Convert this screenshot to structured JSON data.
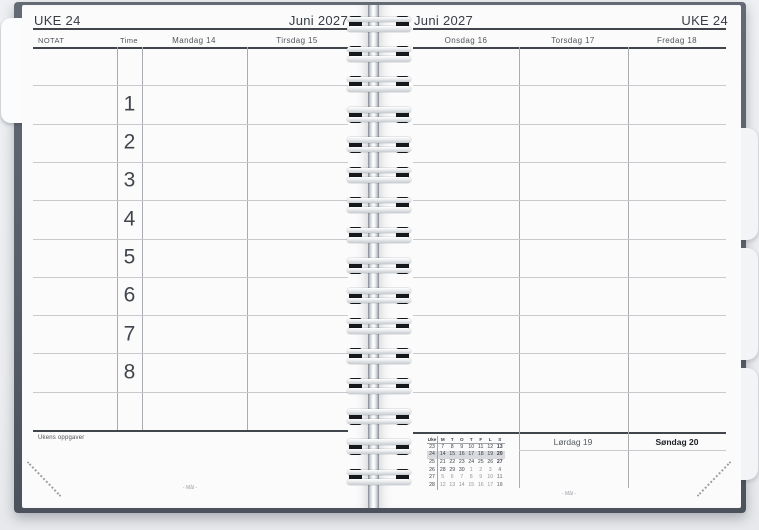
{
  "left_page": {
    "week_label": "UKE 24",
    "month_label": "Juni 2027",
    "columns": {
      "notat": "NOTAT",
      "time": "Time",
      "day1": "Mandag 14",
      "day2": "Tirsdag 15"
    },
    "hours": [
      "1",
      "2",
      "3",
      "4",
      "5",
      "6",
      "7",
      "8"
    ],
    "tasks_label": "Ukens oppgaver",
    "footer": "- Mål -"
  },
  "right_page": {
    "month_label": "Juni 2027",
    "week_label": "UKE 24",
    "columns": [
      "Onsdag 16",
      "Torsdag 17",
      "Fredag 18"
    ],
    "weekend": {
      "saturday": "Lørdag 19",
      "sunday": "Søndag 20"
    },
    "mini_calendar": {
      "header": [
        "Uke",
        "M",
        "T",
        "O",
        "T",
        "F",
        "L",
        "S"
      ],
      "weeks": [
        {
          "week": "23",
          "days": [
            "7",
            "8",
            "9",
            "10",
            "11",
            "12",
            "13"
          ],
          "current": false,
          "dim_from": null
        },
        {
          "week": "24",
          "days": [
            "14",
            "15",
            "16",
            "17",
            "18",
            "19",
            "20"
          ],
          "current": true,
          "dim_from": null
        },
        {
          "week": "25",
          "days": [
            "21",
            "22",
            "23",
            "24",
            "25",
            "26",
            "27"
          ],
          "current": false,
          "dim_from": null
        },
        {
          "week": "26",
          "days": [
            "28",
            "29",
            "30",
            "1",
            "2",
            "3",
            "4"
          ],
          "current": false,
          "dim_from": 3
        },
        {
          "week": "27",
          "days": [
            "5",
            "6",
            "7",
            "8",
            "9",
            "10",
            "11"
          ],
          "current": false,
          "dim_from": 0
        },
        {
          "week": "28",
          "days": [
            "12",
            "13",
            "14",
            "15",
            "16",
            "17",
            "18"
          ],
          "current": false,
          "dim_from": 0
        }
      ]
    },
    "footer": "- Mål -"
  },
  "colors": {
    "page": "#fbfbfc",
    "cover": "#575d67",
    "thick_line": "#41454c",
    "thin_line": "#c8cacd",
    "current_week_highlight": "#d8dadd"
  }
}
